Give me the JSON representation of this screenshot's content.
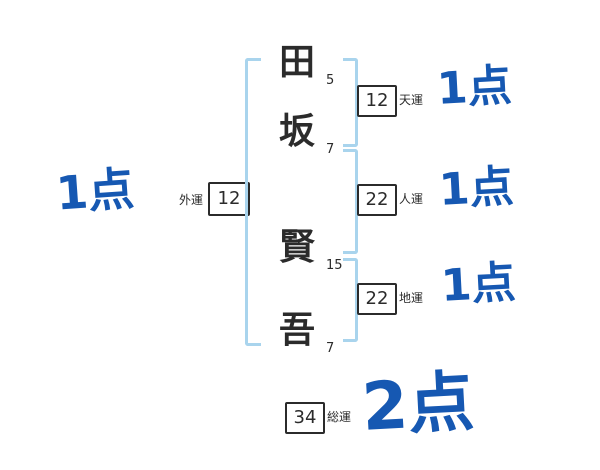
{
  "name": {
    "chars": [
      {
        "char": "田",
        "strokes": "5"
      },
      {
        "char": "坂",
        "strokes": "7"
      },
      {
        "char": "賢",
        "strokes": "15"
      },
      {
        "char": "吾",
        "strokes": "7"
      }
    ]
  },
  "fortunes": {
    "outer": {
      "label": "外運",
      "value": "12",
      "score": "1点"
    },
    "heaven": {
      "label": "天運",
      "value": "12",
      "score": "1点"
    },
    "person": {
      "label": "人運",
      "value": "22",
      "score": "1点"
    },
    "earth": {
      "label": "地運",
      "value": "22",
      "score": "1点"
    },
    "total": {
      "label": "総運",
      "value": "34",
      "score": "2点"
    }
  },
  "colors": {
    "score_blue": "#1658b2",
    "bracket_blue": "#a9d4ed",
    "ink": "#2b2b2b"
  }
}
